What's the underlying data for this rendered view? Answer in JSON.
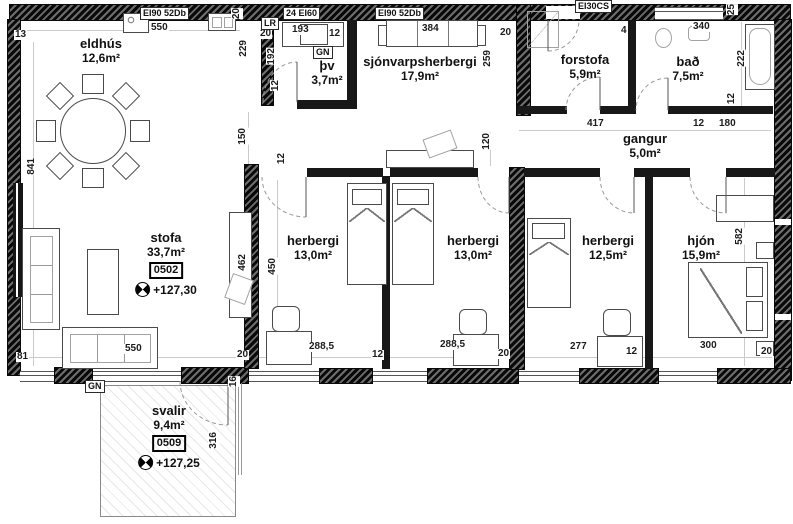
{
  "rooms": {
    "eldhus": {
      "name": "eldhús",
      "area": "12,6m²"
    },
    "thv": {
      "name": "þv",
      "area": "3,7m²"
    },
    "sjonvarp": {
      "name": "sjónvarpsherbergi",
      "area": "17,9m²"
    },
    "forstofa": {
      "name": "forstofa",
      "area": "5,9m²"
    },
    "bad": {
      "name": "bað",
      "area": "7,5m²"
    },
    "gangur": {
      "name": "gangur",
      "area": "5,0m²"
    },
    "stofa": {
      "name": "stofa",
      "area": "33,7m²",
      "unit": "0502",
      "elevation": "+127,30"
    },
    "herbergi1": {
      "name": "herbergi",
      "area": "13,0m²"
    },
    "herbergi2": {
      "name": "herbergi",
      "area": "13,0m²"
    },
    "herbergi3": {
      "name": "herbergi",
      "area": "12,5m²"
    },
    "hjon": {
      "name": "hjón",
      "area": "15,9m²"
    },
    "svalir": {
      "name": "svalir",
      "area": "9,4m²",
      "unit": "0509",
      "elevation": "+127,25"
    }
  },
  "wall_labels": {
    "top_left": "EI90 52Db",
    "thv_top": "24 EI60",
    "tv_top": "EI90 52Db",
    "entry_top": "EI30CS",
    "lr": "LR",
    "gn1": "GN",
    "gn2": "GN"
  },
  "dims": [
    "13",
    "550",
    "20",
    "229",
    "20",
    "192",
    "12",
    "193",
    "12",
    "384",
    "20",
    "259",
    "4",
    "340",
    "25",
    "222",
    "12",
    "12",
    "180",
    "417",
    "120",
    "150",
    "12",
    "841",
    "462",
    "450",
    "550",
    "81",
    "288,5",
    "12",
    "288,5",
    "20",
    "277",
    "12",
    "300",
    "20",
    "20",
    "582",
    "16",
    "316"
  ]
}
